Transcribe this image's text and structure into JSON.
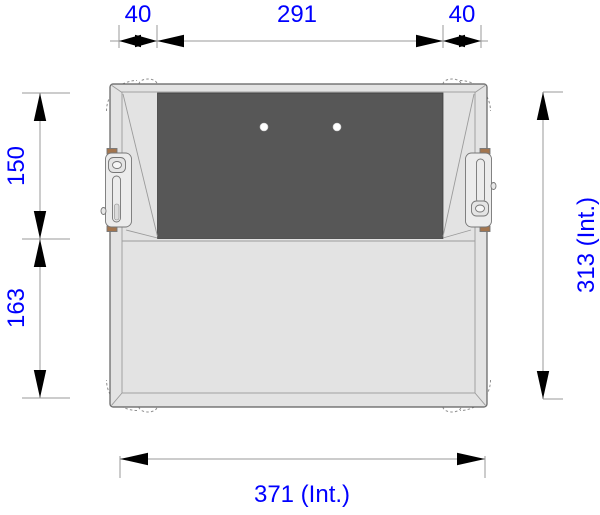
{
  "title": "Case top view dimensioned drawing",
  "colors": {
    "dimension_text": "#0000ff",
    "dimension_line": "#9a9a9a",
    "arrow_fill": "#000000",
    "case_fill": "#e3e3e3",
    "case_inner_fill": "#eaeaea",
    "panel_fill": "#575757",
    "hinge_pin_fill": "#a3754e",
    "background": "#ffffff"
  },
  "dimensions": {
    "top_left": "40",
    "top_center": "291",
    "top_right": "40",
    "left_upper": "150",
    "left_lower": "163",
    "right_side": "313 (Int.)",
    "bottom": "371 (Int.)"
  }
}
